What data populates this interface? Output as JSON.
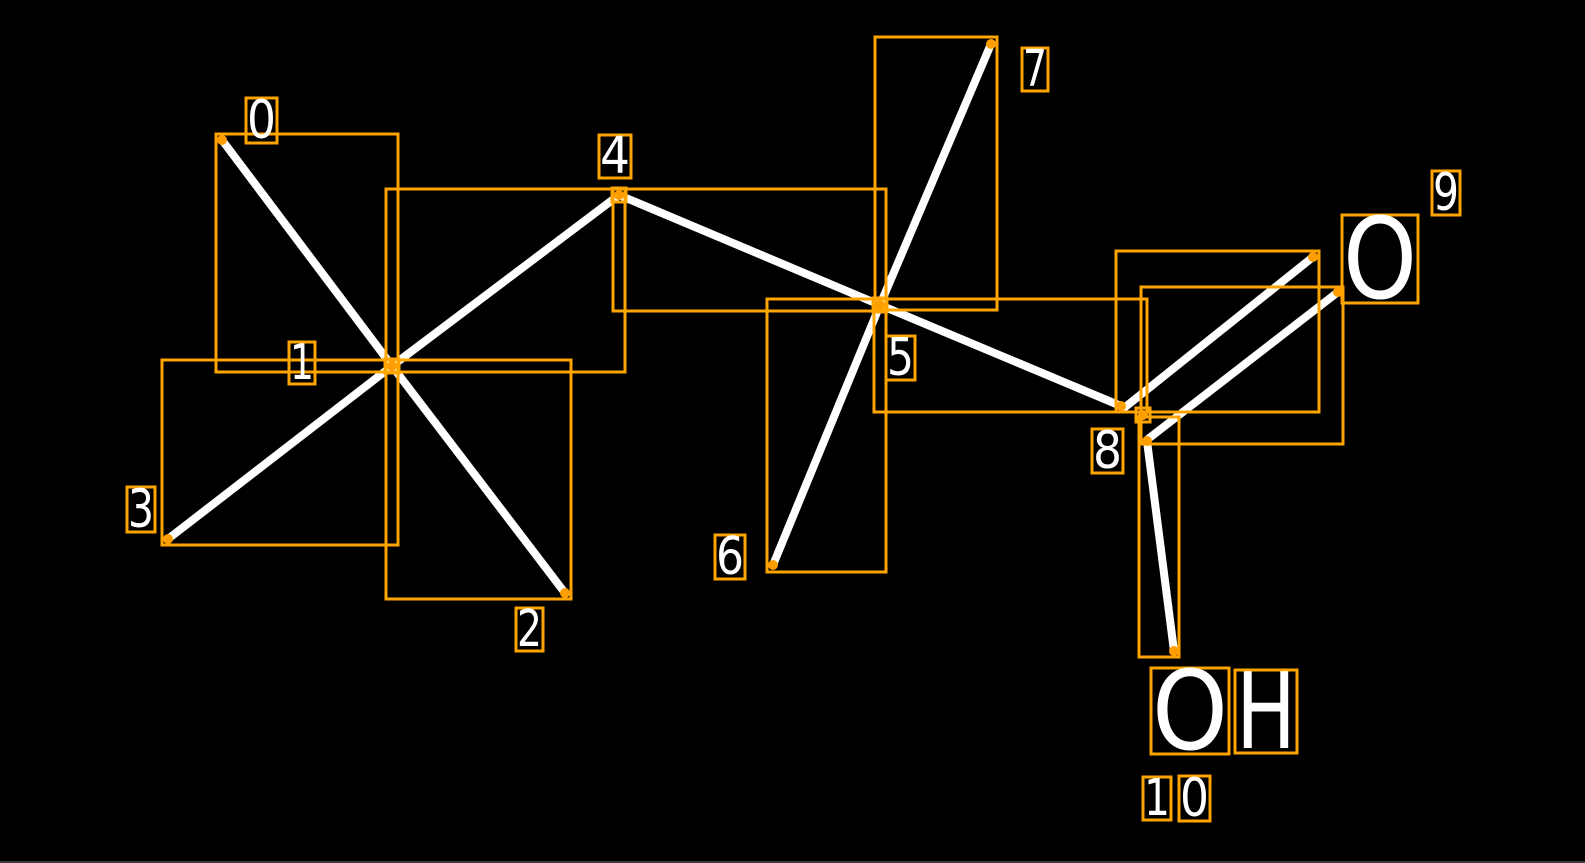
{
  "canvas": {
    "width": 1585,
    "height": 863,
    "background": "#000000",
    "bottom_edge_color": "#3c3c3c"
  },
  "style": {
    "bond_color": "#ffffff",
    "bond_width": 8,
    "box_color": "#ffa500",
    "box_stroke_width": 3,
    "dot_color": "#ff9e00",
    "dot_radius": 5,
    "label_text_color": "#ffffff"
  },
  "molecule": {
    "atom_count": 11,
    "atoms": [
      {
        "index": 0,
        "symbol": "C",
        "implicit": true,
        "x": 222,
        "y": 140
      },
      {
        "index": 1,
        "symbol": "C",
        "implicit": true,
        "x": 392,
        "y": 366
      },
      {
        "index": 2,
        "symbol": "C",
        "implicit": true,
        "x": 565,
        "y": 593
      },
      {
        "index": 3,
        "symbol": "C",
        "implicit": true,
        "x": 168,
        "y": 539
      },
      {
        "index": 4,
        "symbol": "C",
        "implicit": true,
        "x": 619,
        "y": 195
      },
      {
        "index": 5,
        "symbol": "C",
        "implicit": true,
        "x": 880,
        "y": 305
      },
      {
        "index": 6,
        "symbol": "C",
        "implicit": true,
        "x": 773,
        "y": 565
      },
      {
        "index": 7,
        "symbol": "C",
        "implicit": true,
        "x": 991,
        "y": 44
      },
      {
        "index": 8,
        "symbol": "C",
        "implicit": true,
        "x": 1142,
        "y": 415
      },
      {
        "index": 9,
        "symbol": "O",
        "implicit": false,
        "x": 1380,
        "y": 259
      },
      {
        "index": 10,
        "symbol": "OH",
        "implicit": false,
        "x": 1224,
        "y": 711
      }
    ],
    "bonds": [
      {
        "from": 0,
        "to": 1,
        "order": 1
      },
      {
        "from": 1,
        "to": 2,
        "order": 1
      },
      {
        "from": 1,
        "to": 3,
        "order": 1
      },
      {
        "from": 1,
        "to": 4,
        "order": 1
      },
      {
        "from": 4,
        "to": 5,
        "order": 1
      },
      {
        "from": 5,
        "to": 6,
        "order": 1
      },
      {
        "from": 5,
        "to": 7,
        "order": 1
      },
      {
        "from": 5,
        "to": 8,
        "order": 1
      },
      {
        "from": 8,
        "to": 9,
        "order": 2
      },
      {
        "from": 8,
        "to": 10,
        "order": 1
      }
    ]
  },
  "diagram": {
    "bond_lines": [
      {
        "id": "0-1",
        "x1": 222,
        "y1": 140,
        "x2": 392,
        "y2": 366
      },
      {
        "id": "1-2",
        "x1": 392,
        "y1": 366,
        "x2": 565,
        "y2": 593
      },
      {
        "id": "1-3",
        "x1": 392,
        "y1": 366,
        "x2": 168,
        "y2": 539
      },
      {
        "id": "1-4",
        "x1": 392,
        "y1": 366,
        "x2": 619,
        "y2": 195
      },
      {
        "id": "4-5",
        "x1": 619,
        "y1": 195,
        "x2": 880,
        "y2": 305
      },
      {
        "id": "5-6",
        "x1": 880,
        "y1": 305,
        "x2": 773,
        "y2": 565
      },
      {
        "id": "5-7",
        "x1": 880,
        "y1": 305,
        "x2": 991,
        "y2": 44
      },
      {
        "id": "5-8",
        "x1": 880,
        "y1": 305,
        "x2": 1121,
        "y2": 406
      },
      {
        "id": "8-9a",
        "x1": 1124,
        "y1": 408,
        "x2": 1313,
        "y2": 257
      },
      {
        "id": "8-9b",
        "x1": 1148,
        "y1": 439,
        "x2": 1338,
        "y2": 292
      },
      {
        "id": "8-10",
        "x1": 1147,
        "y1": 441,
        "x2": 1174,
        "y2": 651
      }
    ],
    "bond_boxes": [
      {
        "id": "0-1",
        "x": 216,
        "y": 134,
        "w": 182,
        "h": 238
      },
      {
        "id": "1-2",
        "x": 386,
        "y": 360,
        "w": 185,
        "h": 239
      },
      {
        "id": "1-3",
        "x": 162,
        "y": 360,
        "w": 236,
        "h": 185
      },
      {
        "id": "1-4",
        "x": 386,
        "y": 189,
        "w": 239,
        "h": 183
      },
      {
        "id": "4-5",
        "x": 613,
        "y": 189,
        "w": 273,
        "h": 122
      },
      {
        "id": "5-6",
        "x": 767,
        "y": 299,
        "w": 119,
        "h": 273
      },
      {
        "id": "5-7",
        "x": 875,
        "y": 37,
        "w": 122,
        "h": 273
      },
      {
        "id": "5-8",
        "x": 874,
        "y": 299,
        "w": 273,
        "h": 113
      },
      {
        "id": "8-9a",
        "x": 1116,
        "y": 251,
        "w": 203,
        "h": 161
      },
      {
        "id": "8-9b",
        "x": 1141,
        "y": 287,
        "w": 202,
        "h": 157
      },
      {
        "id": "8-10",
        "x": 1139,
        "y": 417,
        "w": 40,
        "h": 240
      }
    ],
    "atom_marker_boxes": [
      {
        "atom": 1,
        "x": 385,
        "y": 359,
        "w": 14,
        "h": 14
      },
      {
        "atom": 4,
        "x": 612,
        "y": 188,
        "w": 14,
        "h": 14
      },
      {
        "atom": 5,
        "x": 873,
        "y": 298,
        "w": 14,
        "h": 14
      },
      {
        "atom": 8,
        "x": 1136,
        "y": 408,
        "w": 14,
        "h": 14
      }
    ],
    "endpoint_dots": [
      {
        "x": 222,
        "y": 140
      },
      {
        "x": 392,
        "y": 366
      },
      {
        "x": 565,
        "y": 593
      },
      {
        "x": 168,
        "y": 539
      },
      {
        "x": 619,
        "y": 195
      },
      {
        "x": 880,
        "y": 305
      },
      {
        "x": 773,
        "y": 565
      },
      {
        "x": 991,
        "y": 44
      },
      {
        "x": 1121,
        "y": 406
      },
      {
        "x": 1143,
        "y": 415
      },
      {
        "x": 1147,
        "y": 441
      },
      {
        "x": 1313,
        "y": 257
      },
      {
        "x": 1338,
        "y": 292
      },
      {
        "x": 1174,
        "y": 651
      }
    ],
    "index_labels": [
      {
        "label": "0",
        "text": "0",
        "x": 246,
        "y": 98,
        "w": 31,
        "h": 45
      },
      {
        "label": "1",
        "text": "1",
        "x": 289,
        "y": 342,
        "w": 26,
        "h": 42
      },
      {
        "label": "2",
        "text": "2",
        "x": 516,
        "y": 608,
        "w": 27,
        "h": 43
      },
      {
        "label": "3",
        "text": "3",
        "x": 127,
        "y": 487,
        "w": 28,
        "h": 45
      },
      {
        "label": "4",
        "text": "4",
        "x": 599,
        "y": 135,
        "w": 32,
        "h": 43
      },
      {
        "label": "5",
        "text": "5",
        "x": 886,
        "y": 336,
        "w": 29,
        "h": 44
      },
      {
        "label": "6",
        "text": "6",
        "x": 715,
        "y": 535,
        "w": 30,
        "h": 44
      },
      {
        "label": "7",
        "text": "7",
        "x": 1022,
        "y": 48,
        "w": 26,
        "h": 43
      },
      {
        "label": "8",
        "text": "8",
        "x": 1092,
        "y": 429,
        "w": 31,
        "h": 44
      },
      {
        "label": "9",
        "text": "9",
        "x": 1432,
        "y": 171,
        "w": 28,
        "h": 44
      },
      {
        "label": "10",
        "text": "1",
        "x": 1143,
        "y": 777,
        "w": 28,
        "h": 43
      },
      {
        "label": "10",
        "text": "0",
        "x": 1179,
        "y": 776,
        "w": 31,
        "h": 45
      }
    ],
    "atom_symbol_labels": [
      {
        "atom": 9,
        "text": "O",
        "x": 1342,
        "y": 215,
        "w": 76,
        "h": 88
      },
      {
        "atom": 10,
        "text": "O",
        "x": 1151,
        "y": 668,
        "w": 78,
        "h": 86
      },
      {
        "atom": 10,
        "text": "H",
        "x": 1235,
        "y": 670,
        "w": 62,
        "h": 83
      }
    ]
  }
}
